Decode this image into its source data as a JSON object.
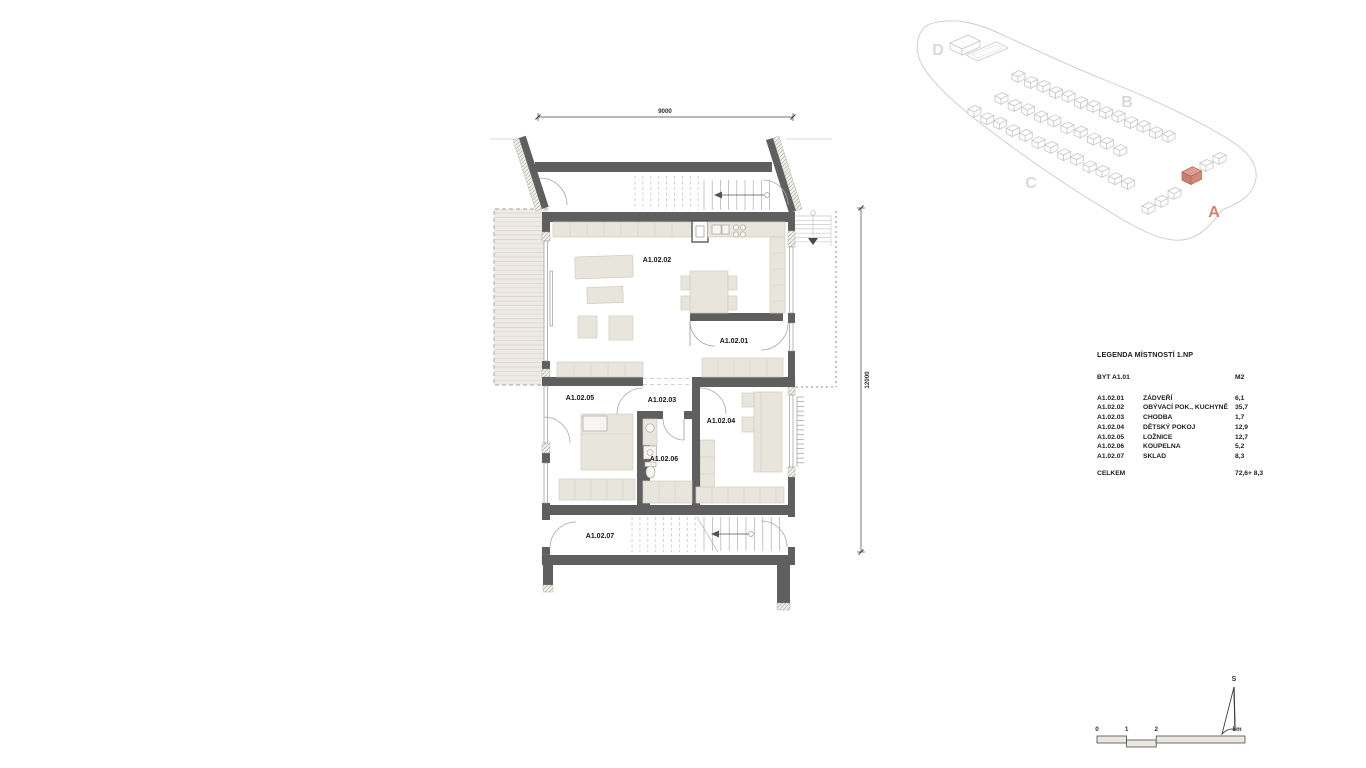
{
  "plan": {
    "dim_top": "9000",
    "dim_right": "12000",
    "rooms": {
      "r01": "A1.02.01",
      "r02": "A1.02.02",
      "r03": "A1.02.03",
      "r04": "A1.02.04",
      "r05": "A1.02.05",
      "r06": "A1.02.06",
      "r07": "A1.02.07"
    }
  },
  "site": {
    "labels": {
      "a": "A",
      "b": "B",
      "c": "C",
      "d": "D"
    },
    "highlight_color": "#d08a7b"
  },
  "legend": {
    "title": "LEGENDA MÍSTNOSTÍ 1.NP",
    "apartment": "BYT A1.01",
    "unit_header": "M2",
    "rows": [
      {
        "code": "A1.02.01",
        "name": "ZÁDVEŘÍ",
        "area": "6,1"
      },
      {
        "code": "A1.02.02",
        "name": "OBÝVACÍ POK., KUCHYNĚ",
        "area": "35,7"
      },
      {
        "code": "A1.02.03",
        "name": "CHODBA",
        "area": "1,7"
      },
      {
        "code": "A1.02.04",
        "name": "DĚTSKÝ POKOJ",
        "area": "12,9"
      },
      {
        "code": "A1.02.05",
        "name": "LOŽNICE",
        "area": "12,7"
      },
      {
        "code": "A1.02.06",
        "name": "KOUPELNA",
        "area": "5,2"
      },
      {
        "code": "A1.02.07",
        "name": "SKLAD",
        "area": "8,3"
      }
    ],
    "total_label": "CELKEM",
    "total_value": "72,6+ 8,3"
  },
  "scalebar": {
    "ticks": [
      "0",
      "1",
      "2",
      "5m"
    ],
    "north_label": "S"
  }
}
